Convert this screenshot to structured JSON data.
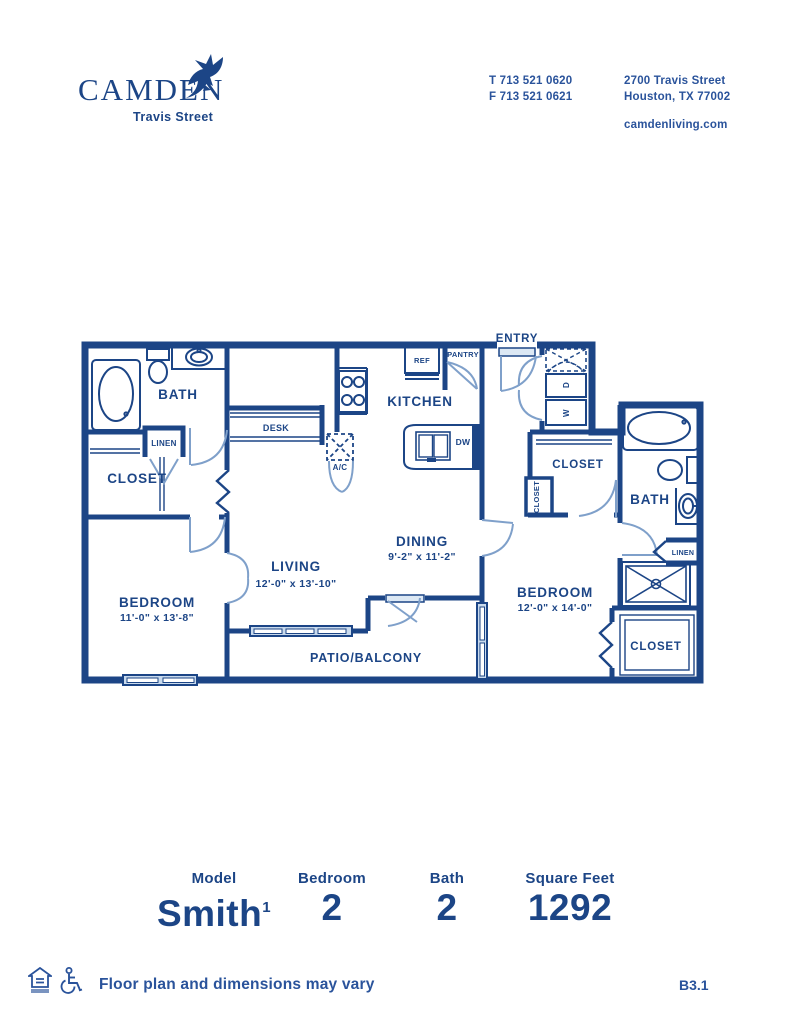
{
  "brand": {
    "name": "CAMDEN",
    "subtitle": "Travis Street"
  },
  "contact": {
    "phone1": "T 713 521 0620",
    "phone2": "F 713 521 0621",
    "address1": "2700 Travis Street",
    "address2": "Houston, TX 77002",
    "website": "camdenliving.com"
  },
  "plan": {
    "labels": {
      "bath1": "BATH",
      "linen1": "LINEN",
      "closet1": "CLOSET",
      "bedroom1": "BEDROOM",
      "bedroom1_dims": "11'-0\" x 13'-8\"",
      "desk": "DESK",
      "ac": "A/C",
      "living": "LIVING",
      "living_dims": "12'-0\" x 13'-10\"",
      "kitchen": "KITCHEN",
      "ref": "REF",
      "pantry": "PANTRY",
      "entry": "ENTRY",
      "dw": "DW",
      "dryer": "D",
      "washer": "W",
      "dining": "DINING",
      "dining_dims": "9'-2\" x 11'-2\"",
      "closet_hall": "CLOSET",
      "closet2": "CLOSET",
      "bath2": "BATH",
      "linen2": "LINEN",
      "bedroom2": "BEDROOM",
      "bedroom2_dims": "12'-0\" x 14'-0\"",
      "closet3": "CLOSET",
      "patio": "PATIO/BALCONY"
    }
  },
  "summary": {
    "items": [
      {
        "label": "Model",
        "value": "Smith",
        "sup": "1"
      },
      {
        "label": "Bedroom",
        "value": "2"
      },
      {
        "label": "Bath",
        "value": "2"
      },
      {
        "label": "Square Feet",
        "value": "1292"
      }
    ]
  },
  "footer": {
    "disclaimer": "Floor plan and dimensions may vary",
    "plan_code": "B3.1"
  },
  "colors": {
    "navy": "#1c4586",
    "door_blue": "#7fa0ca",
    "window_fill": "#c9daed"
  }
}
